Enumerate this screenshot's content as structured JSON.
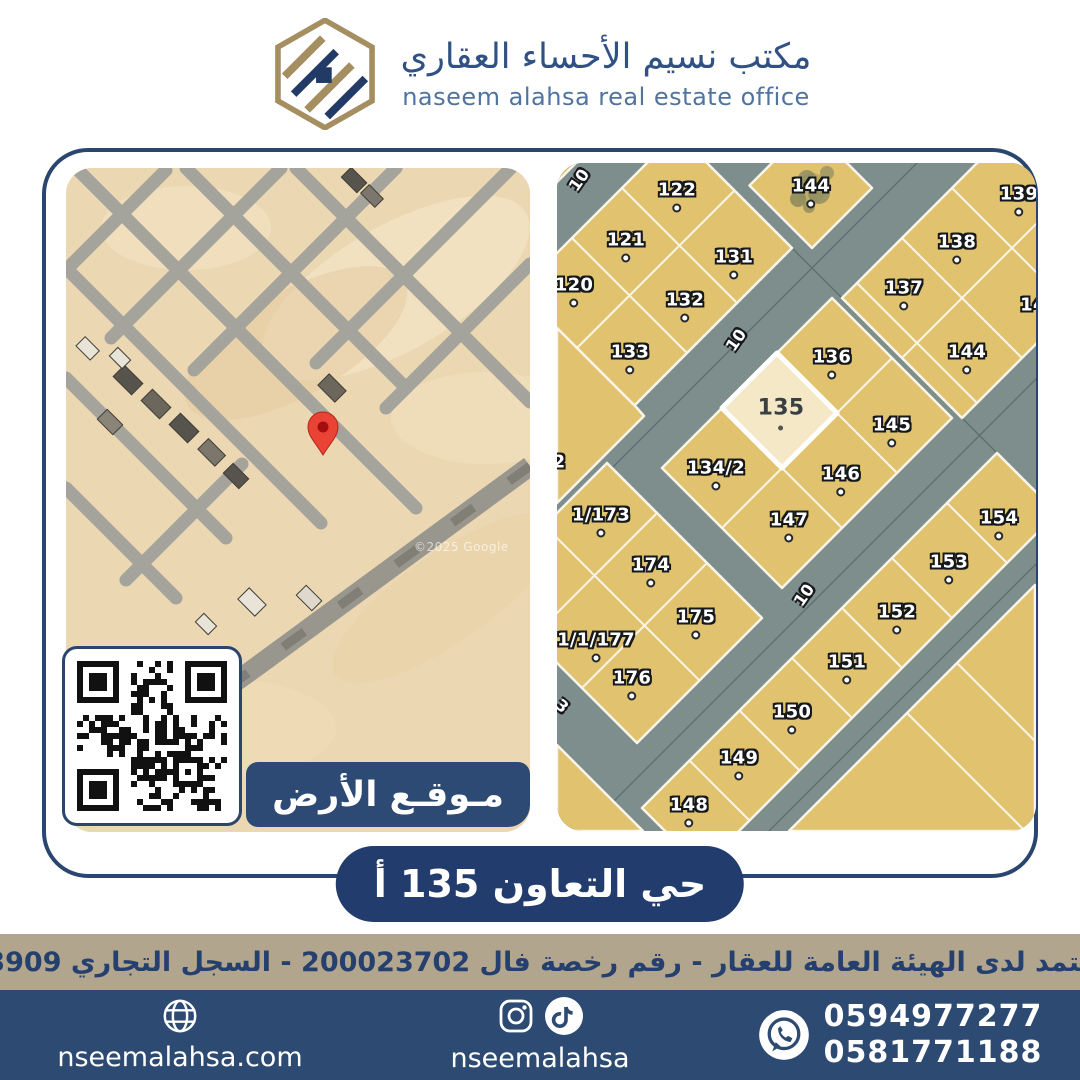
{
  "header": {
    "title_ar": "مكتب نسيم الأحساء العقاري",
    "title_en": "naseem alahsa real estate office"
  },
  "left_map": {
    "watermark": "©2025 Google",
    "location_banner": "مـوقـع الأرض"
  },
  "right_map": {
    "highlighted_plot": "135",
    "street_labels": [
      {
        "text": "10",
        "x": 22,
        "y": 17,
        "rot": -55
      },
      {
        "text": "10",
        "x": 179,
        "y": 177,
        "rot": -55
      },
      {
        "text": "10",
        "x": 247,
        "y": 432,
        "rot": -55
      },
      {
        "text": "3",
        "x": 5,
        "y": 543,
        "rot": 40
      }
    ],
    "plot_labels": [
      {
        "text": "122",
        "x": 120,
        "y": 27,
        "dot": true
      },
      {
        "text": "144",
        "x": 254,
        "y": 23,
        "dot": true
      },
      {
        "text": "139",
        "x": 462,
        "y": 31,
        "dot": true
      },
      {
        "text": "121",
        "x": 69,
        "y": 77,
        "dot": true
      },
      {
        "text": "131",
        "x": 177,
        "y": 94,
        "dot": true
      },
      {
        "text": "138",
        "x": 400,
        "y": 79,
        "dot": true
      },
      {
        "text": "120",
        "x": 17,
        "y": 122,
        "dot": true
      },
      {
        "text": "132",
        "x": 128,
        "y": 137,
        "dot": true
      },
      {
        "text": "137",
        "x": 347,
        "y": 125,
        "dot": true
      },
      {
        "text": "14",
        "x": 476,
        "y": 142,
        "dot": false
      },
      {
        "text": "133",
        "x": 73,
        "y": 189,
        "dot": true
      },
      {
        "text": "136",
        "x": 275,
        "y": 194,
        "dot": true
      },
      {
        "text": "144",
        "x": 410,
        "y": 189,
        "dot": true
      },
      {
        "text": "135",
        "x": 224,
        "y": 245,
        "dot": true,
        "highlight": true
      },
      {
        "text": "145",
        "x": 335,
        "y": 262,
        "dot": true
      },
      {
        "text": "134/2",
        "x": 159,
        "y": 305,
        "dot": true
      },
      {
        "text": "146",
        "x": 284,
        "y": 311,
        "dot": true
      },
      {
        "text": "2",
        "x": 2,
        "y": 299,
        "dot": false
      },
      {
        "text": "1/173",
        "x": 44,
        "y": 352,
        "dot": true
      },
      {
        "text": "147",
        "x": 232,
        "y": 357,
        "dot": true
      },
      {
        "text": "154",
        "x": 442,
        "y": 355,
        "dot": true
      },
      {
        "text": "174",
        "x": 94,
        "y": 402,
        "dot": true
      },
      {
        "text": "153",
        "x": 392,
        "y": 399,
        "dot": true
      },
      {
        "text": "175",
        "x": 139,
        "y": 454,
        "dot": true
      },
      {
        "text": "152",
        "x": 340,
        "y": 449,
        "dot": true
      },
      {
        "text": "1/1/177",
        "x": 39,
        "y": 477,
        "dot": true
      },
      {
        "text": "151",
        "x": 290,
        "y": 499,
        "dot": true
      },
      {
        "text": "176",
        "x": 75,
        "y": 515,
        "dot": true
      },
      {
        "text": "150",
        "x": 235,
        "y": 549,
        "dot": true
      },
      {
        "text": "149",
        "x": 182,
        "y": 595,
        "dot": true
      },
      {
        "text": "148",
        "x": 132,
        "y": 642,
        "dot": true
      }
    ]
  },
  "district_banner": {
    "text": "حي التعاون 135 أ"
  },
  "accreditation": {
    "text": "مسوق معتمد لدى الهيئة العامة للعقار - رقم رخصة فال 200023702 - السجل التجاري 2250373909"
  },
  "footer": {
    "website": "nseemalahsa.com",
    "social_handle": "nseemalahsa",
    "phones": [
      "0594977277",
      "0581771188"
    ]
  },
  "colors": {
    "navy": "#223c6d",
    "navy_footer": "#2c4a72",
    "tan_strip": "#b2a58d",
    "parcel": "#e1c36f",
    "parcel_highlight": "#f4e8c6",
    "road": "#7e8e8c",
    "sand": "#ecd7b3",
    "pin_red": "#e94335",
    "logo_tan": "#a58e60",
    "title_blue": "#2f5183",
    "subtitle_blue": "#50739f"
  }
}
